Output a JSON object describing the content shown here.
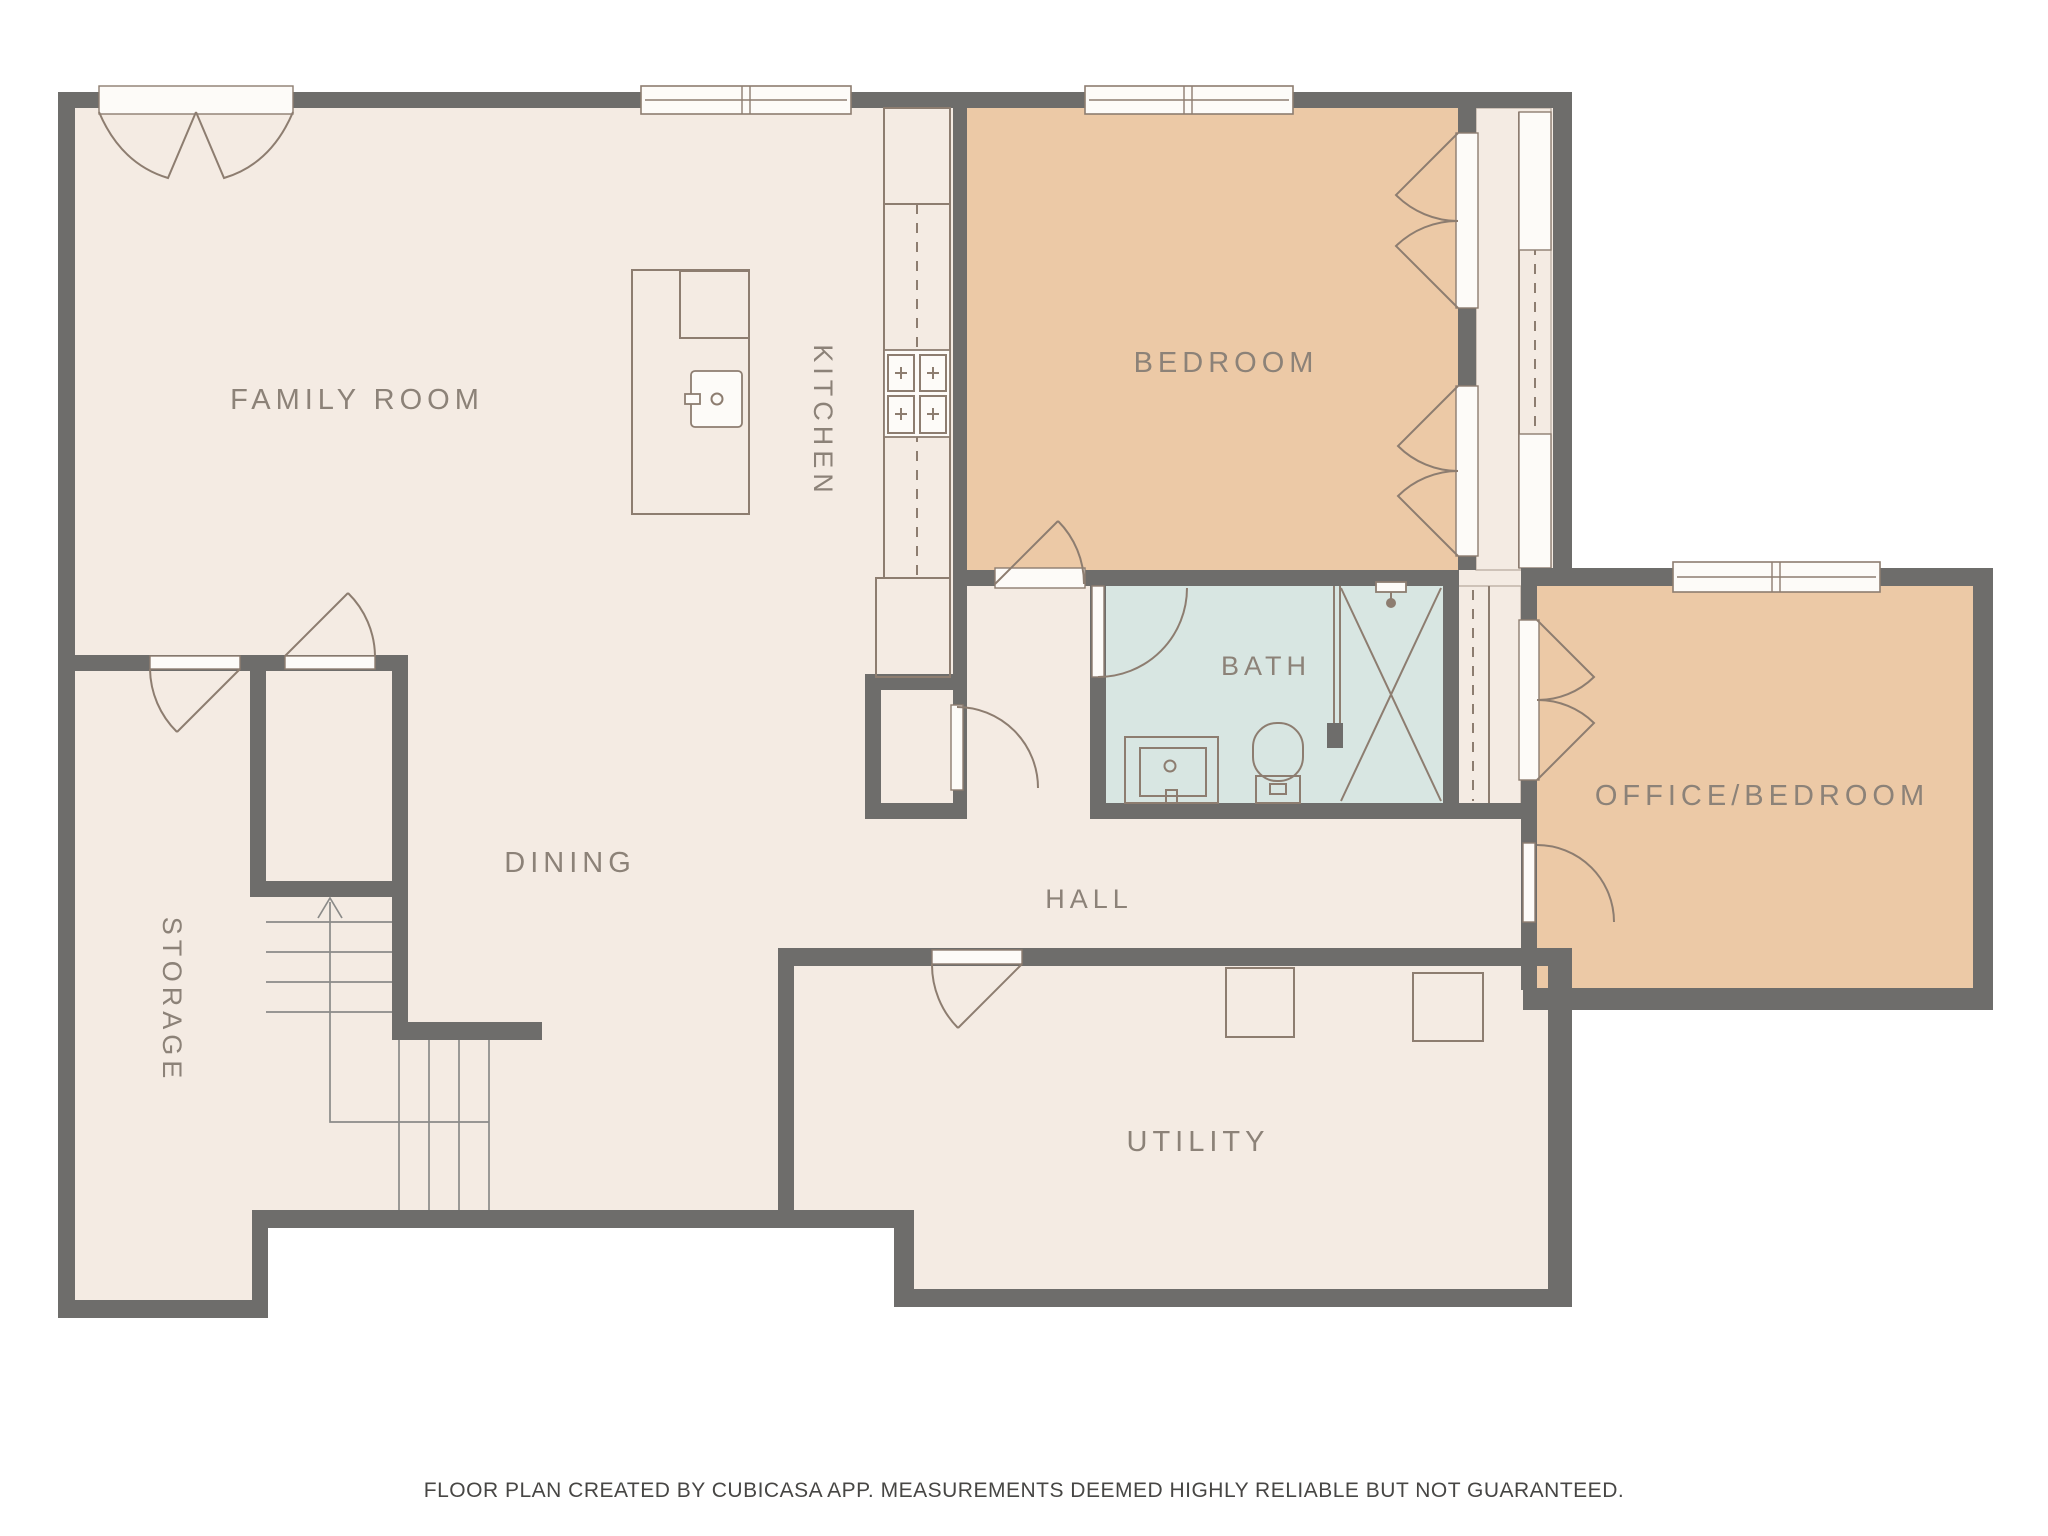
{
  "title": "Floor plan",
  "rooms": [
    {
      "id": "family-room",
      "label": "FAMILY ROOM",
      "floor_color_key": "floor",
      "label_orientation": "horizontal"
    },
    {
      "id": "kitchen",
      "label": "KITCHEN",
      "floor_color_key": "floor",
      "label_orientation": "vertical"
    },
    {
      "id": "bedroom",
      "label": "BEDROOM",
      "floor_color_key": "tan",
      "label_orientation": "horizontal"
    },
    {
      "id": "bath",
      "label": "BATH",
      "floor_color_key": "blue",
      "label_orientation": "horizontal"
    },
    {
      "id": "office-bedroom",
      "label": "OFFICE/BEDROOM",
      "floor_color_key": "tan",
      "label_orientation": "horizontal"
    },
    {
      "id": "dining",
      "label": "DINING",
      "floor_color_key": "floor",
      "label_orientation": "horizontal"
    },
    {
      "id": "hall",
      "label": "HALL",
      "floor_color_key": "floor",
      "label_orientation": "horizontal"
    },
    {
      "id": "storage",
      "label": "STORAGE",
      "floor_color_key": "floor",
      "label_orientation": "vertical"
    },
    {
      "id": "utility",
      "label": "UTILITY",
      "floor_color_key": "floor",
      "label_orientation": "horizontal"
    }
  ],
  "fixtures": [
    "kitchen-island-with-sink",
    "kitchen-counter",
    "stove-4-burners",
    "refrigerator-cabinet",
    "bath-vanity-sink",
    "toilet",
    "shower-with-head",
    "closet-rails",
    "staircase-with-up-arrow",
    "washer-square",
    "dryer-square"
  ],
  "footer": {
    "text": "FLOOR PLAN CREATED BY CUBICASA APP. MEASUREMENTS DEEMED HIGHLY RELIABLE BUT NOT GUARANTEED."
  },
  "colors": {
    "floor": "#f4ebe3",
    "wall": "#6e6d6b",
    "tan": "#ecc9a6",
    "blue": "#d8e6e2",
    "line": "#8d7d70",
    "stairline": "#8b8b89",
    "labelcol": "#8c8278",
    "footercol": "#474644",
    "white": "#fdfbf8",
    "closetline": "#b9aca0"
  }
}
